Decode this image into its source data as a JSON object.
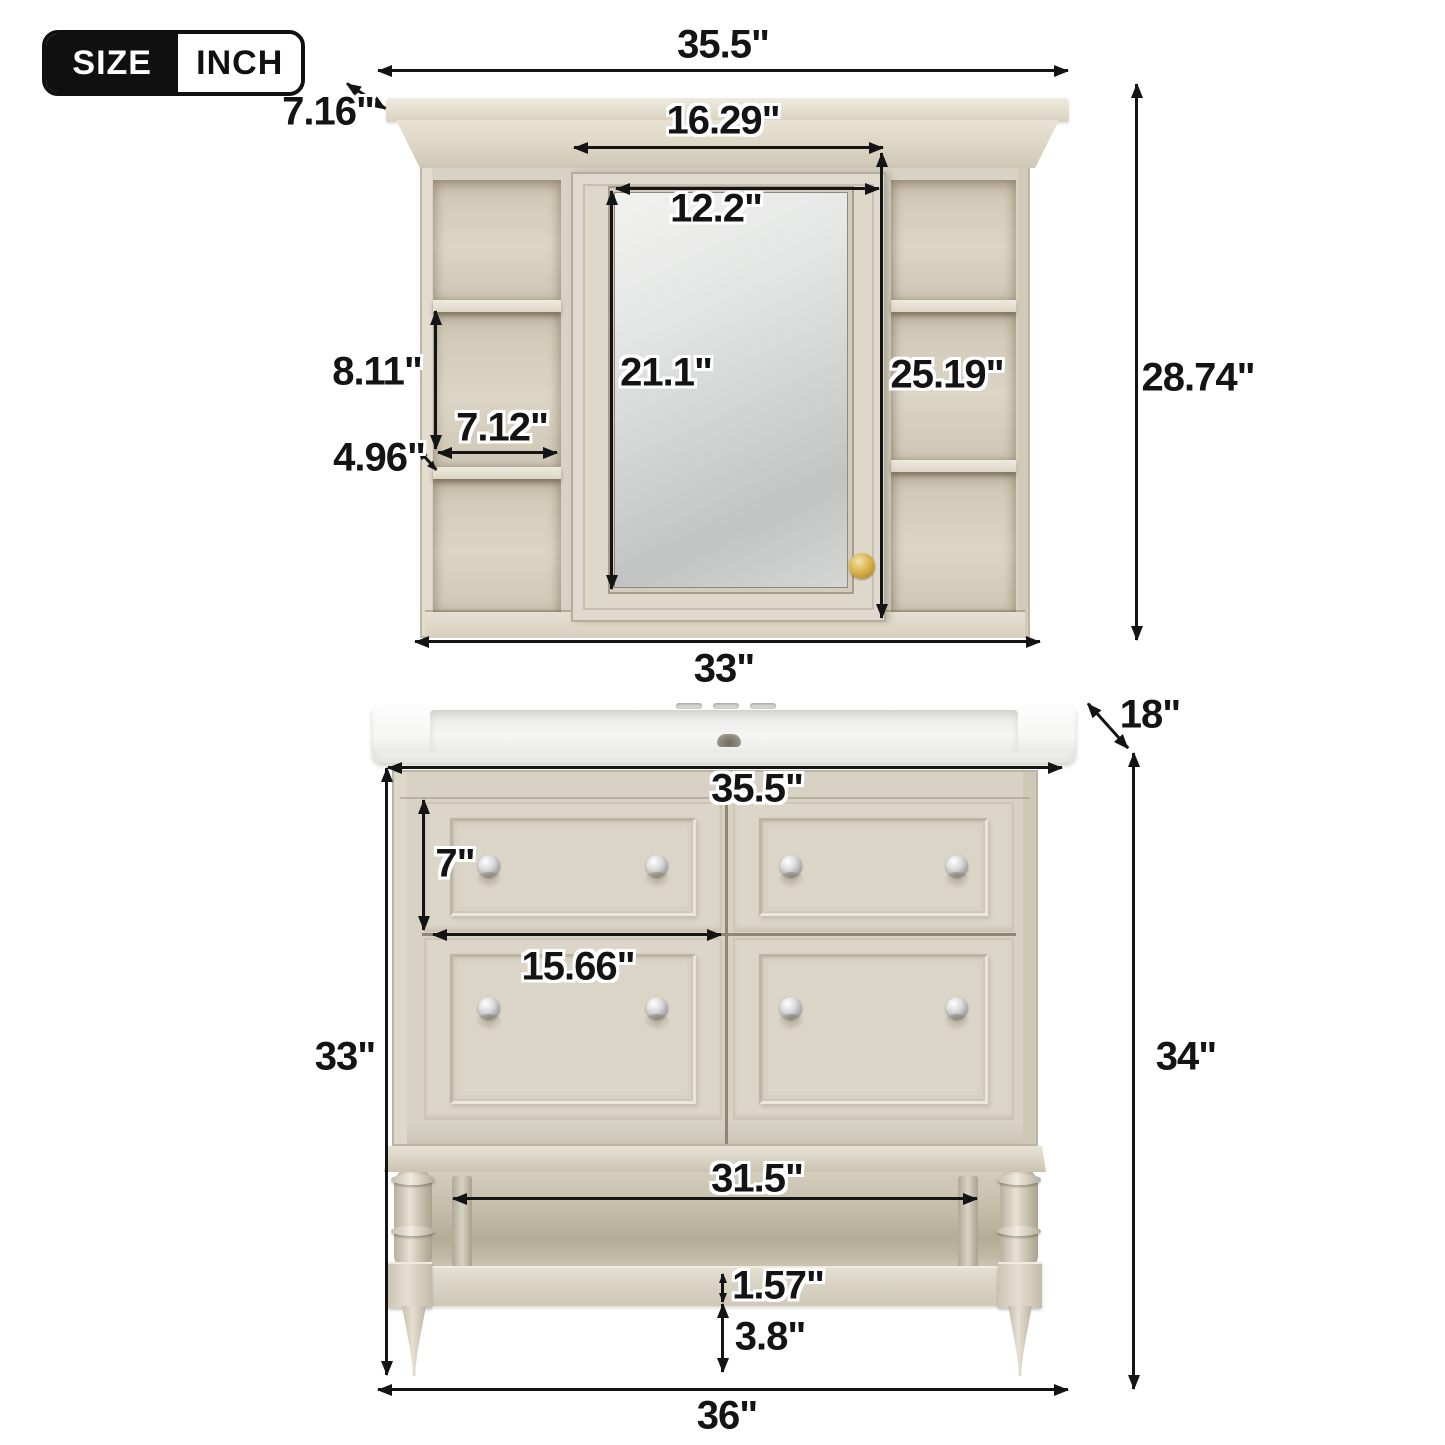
{
  "badge": {
    "size": "SIZE",
    "unit": "INCH"
  },
  "colors": {
    "wood": "#dcd6c8",
    "wood_shadow": "#b5ac97",
    "mirror": "#d4d6d5",
    "sink": "#ffffff",
    "dimension_line": "#141414",
    "knob_gold": "#d9b44a",
    "knob_chrome": "#c9c9c9",
    "background": "#ffffff"
  },
  "mirror_cabinet": {
    "overall_width": "35.5\"",
    "depth": "7.16\"",
    "door_width": "16.29\"",
    "mirror_width": "12.2\"",
    "mirror_height": "21.1\"",
    "side_opening_height": "8.11\"",
    "side_shelf_width": "7.12\"",
    "side_shelf_depth": "4.96\"",
    "side_column_height": "25.19\"",
    "overall_height": "28.74\"",
    "body_width": "33\""
  },
  "vanity": {
    "depth": "18\"",
    "top_width": "35.5\"",
    "drawer_height": "7\"",
    "drawer_width": "15.66\"",
    "open_shelf_width": "31.5\"",
    "shelf_thickness": "1.57\"",
    "foot_height": "3.8\"",
    "cabinet_height": "33\"",
    "overall_height": "34\"",
    "overall_width": "36\""
  }
}
